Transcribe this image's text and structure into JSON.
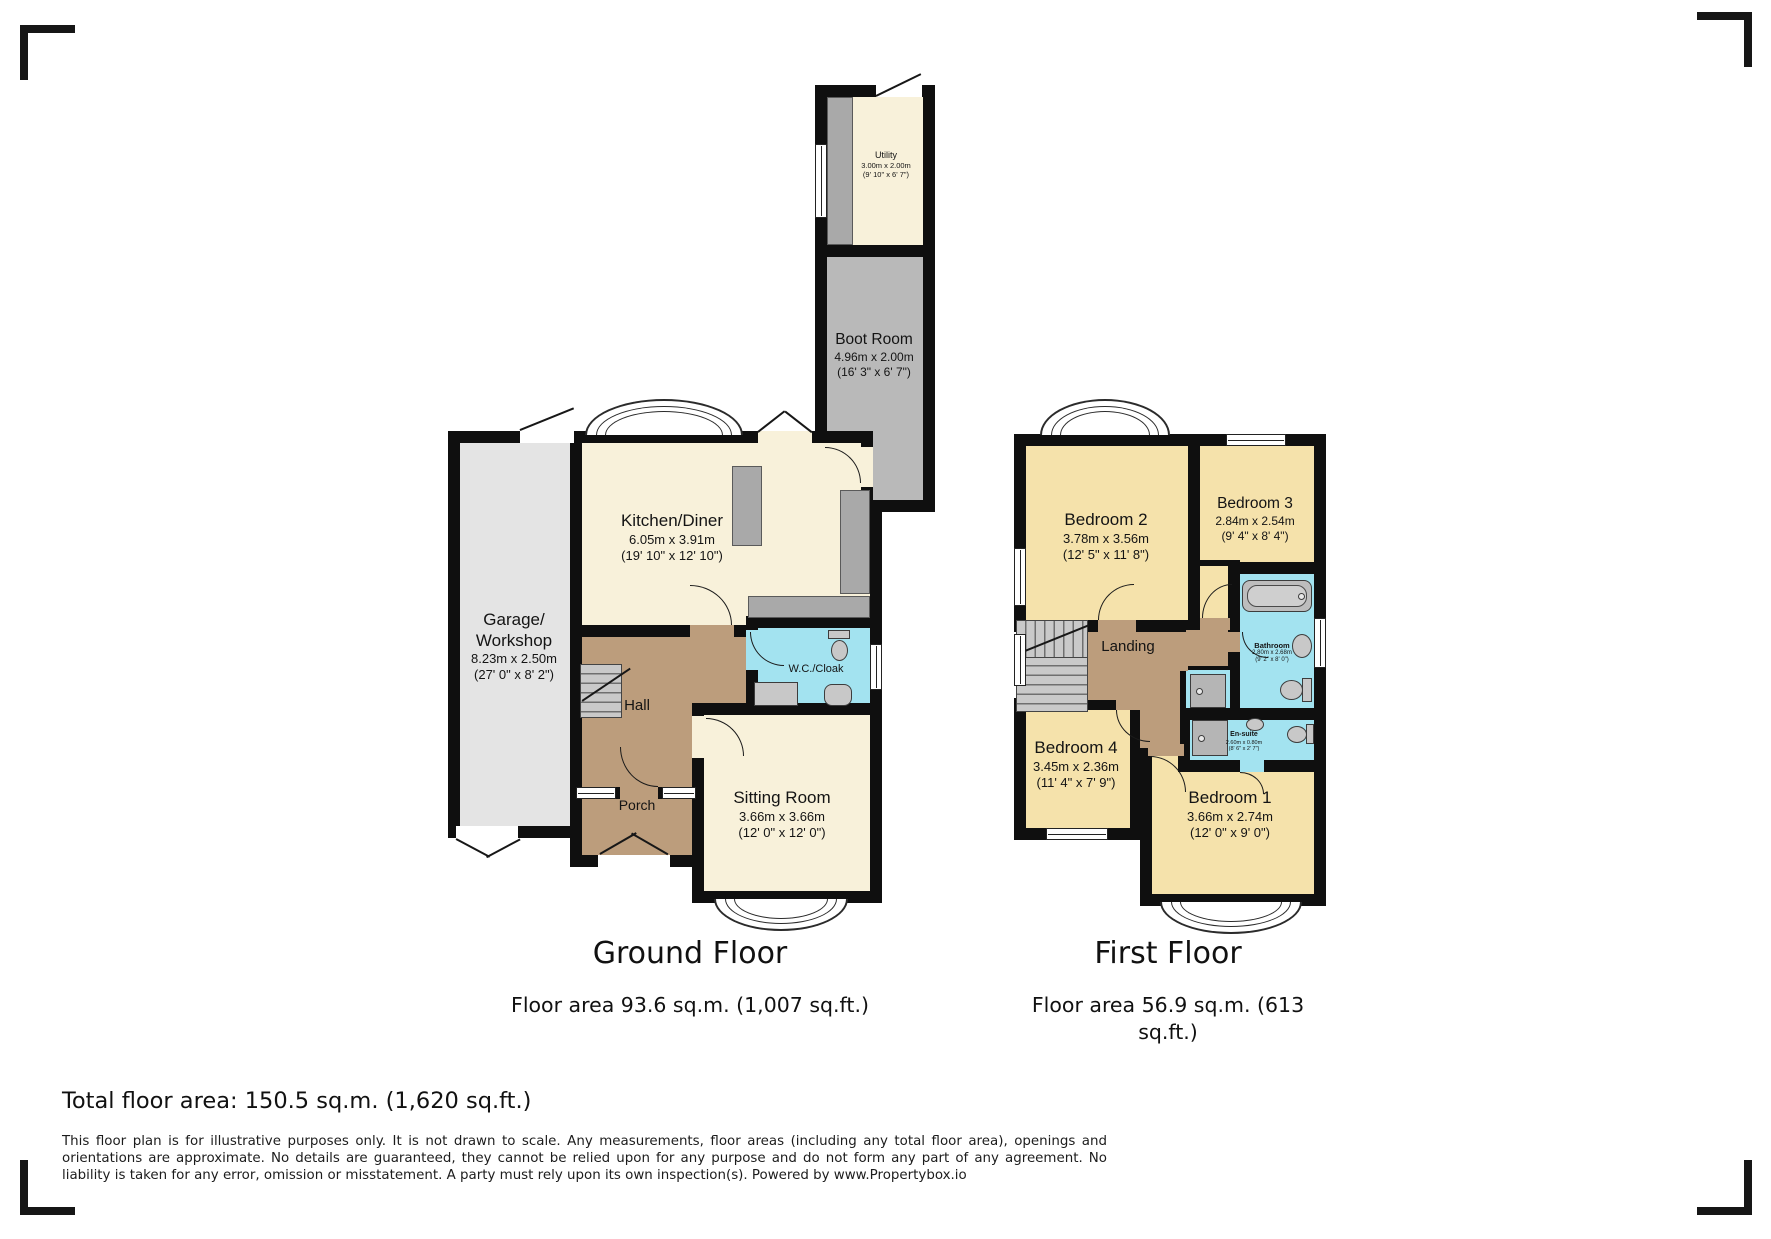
{
  "ground": {
    "title": "Ground Floor",
    "area": "Floor area 93.6 sq.m. (1,007 sq.ft.)",
    "rooms": {
      "utility": {
        "name": "Utility",
        "m": "3.00m x 2.00m",
        "ft": "(9' 10\" x 6' 7\")"
      },
      "boot": {
        "name": "Boot Room",
        "m": "4.96m x 2.00m",
        "ft": "(16' 3\" x 6' 7\")"
      },
      "kitchen": {
        "name": "Kitchen/Diner",
        "m": "6.05m x 3.91m",
        "ft": "(19' 10\" x 12' 10\")"
      },
      "garage": {
        "name": "Garage/ Workshop",
        "m": "8.23m x 2.50m",
        "ft": "(27' 0\" x 8' 2\")"
      },
      "hall": {
        "name": "Hall"
      },
      "porch": {
        "name": "Porch"
      },
      "wc": {
        "name": "W.C./Cloak"
      },
      "sitting": {
        "name": "Sitting Room",
        "m": "3.66m x 3.66m",
        "ft": "(12' 0\" x 12' 0\")"
      }
    }
  },
  "first": {
    "title": "First Floor",
    "area": "Floor area 56.9 sq.m. (613 sq.ft.)",
    "rooms": {
      "bed2": {
        "name": "Bedroom 2",
        "m": "3.78m x 3.56m",
        "ft": "(12' 5\" x 11' 8\")"
      },
      "bed3": {
        "name": "Bedroom 3",
        "m": "2.84m x 2.54m",
        "ft": "(9' 4\" x 8' 4\")"
      },
      "bed4": {
        "name": "Bedroom 4",
        "m": "3.45m x 2.36m",
        "ft": "(11' 4\" x 7' 9\")"
      },
      "bed1": {
        "name": "Bedroom 1",
        "m": "3.66m x 2.74m",
        "ft": "(12' 0\" x 9' 0\")"
      },
      "landing": {
        "name": "Landing"
      },
      "bathroom": {
        "name": "Bathroom",
        "m": "2.80m x 2.68m",
        "ft": "(9' 2\" x 8' 0\")"
      },
      "ensuite": {
        "name": "En-suite",
        "m": "2.60m x 0.80m",
        "ft": "(8' 6\" x 2' 7\")"
      }
    }
  },
  "total": "Total floor area: 150.5 sq.m. (1,620 sq.ft.)",
  "disclaimer": "This floor plan is for illustrative purposes only. It is not drawn to scale. Any measurements, floor areas (including any total floor area), openings and orientations are approximate. No details are guaranteed, they cannot be relied upon for any purpose and do not form any part of any agreement. No liability is taken for any error, omission or misstatement. A party must rely upon its own inspection(s). Powered by www.Propertybox.io",
  "colors": {
    "wall": "#0f0f0f",
    "ground_room": "#f8f1da",
    "bedroom": "#f5e2ab",
    "hallway": "#bc9d7c",
    "wet_room": "#a3e3f0",
    "boot_room": "#b9b9b9",
    "garage": "#e4e4e4"
  }
}
